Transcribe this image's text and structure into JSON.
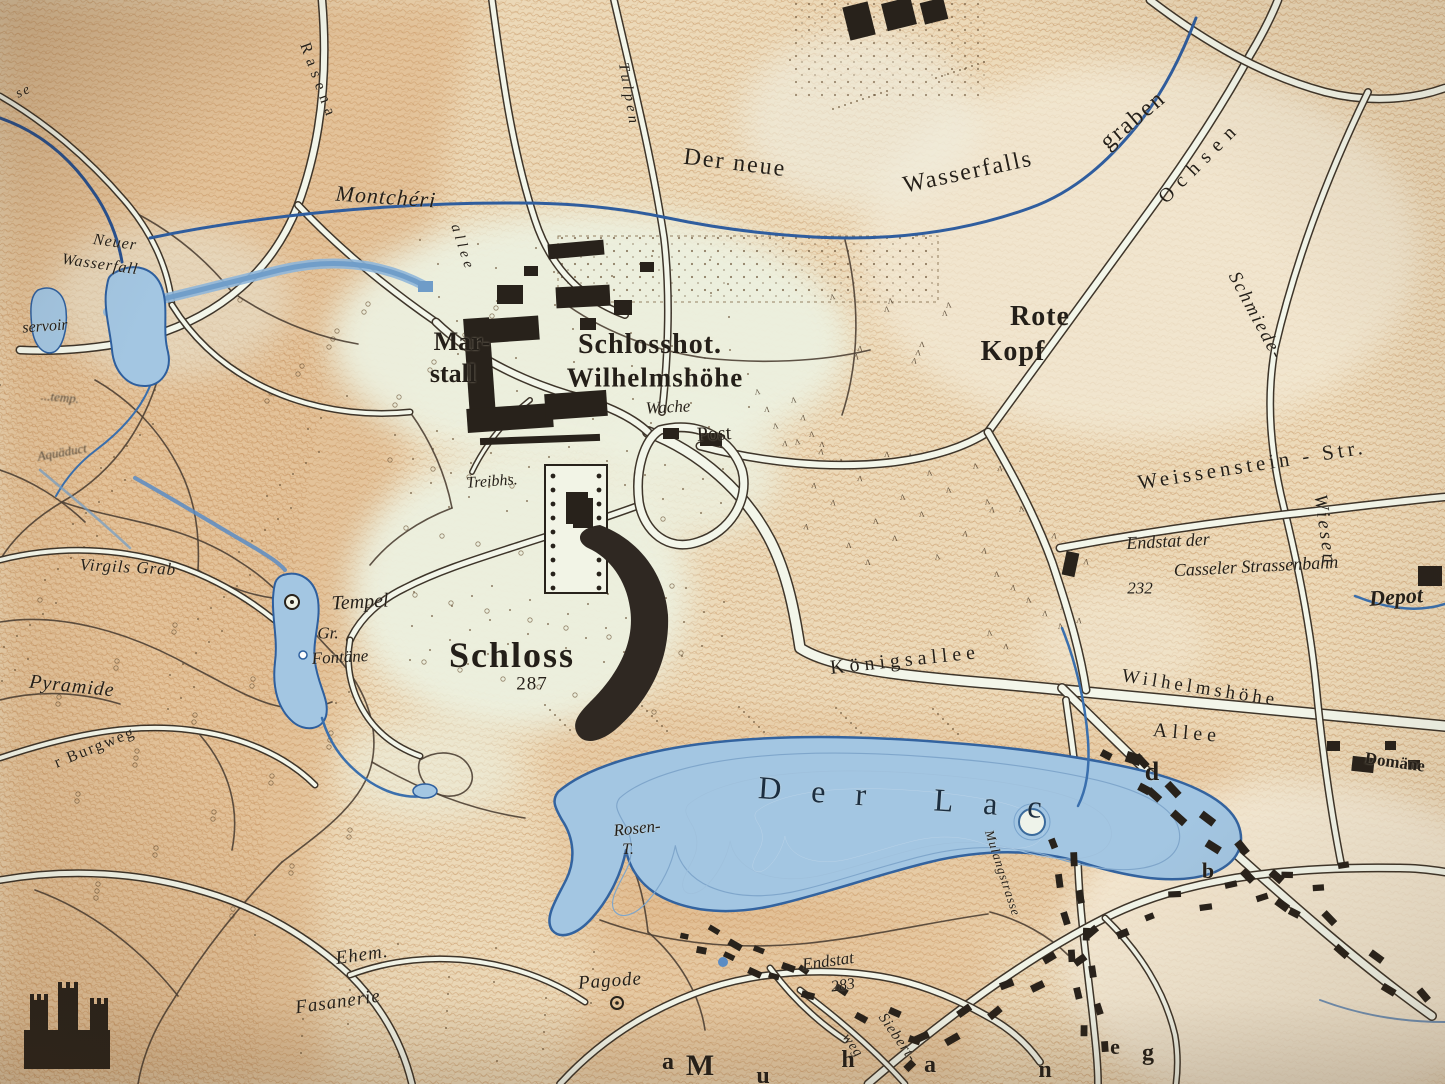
{
  "map": {
    "colors": {
      "paper": "#ecd9b8",
      "hatch": "#c08a55",
      "orange_tint": "#cf9055",
      "park_light": "#edf1e0",
      "road_fill": "#f3f6ea",
      "road_edge": "#3e352a",
      "path_brown": "#4e4034",
      "water_fill": "#a3c6e2",
      "water_edge": "#2e5f9e",
      "stream_blue": "#2f5d9e",
      "cascade_blue": "#6f9cc8",
      "building_ink": "#28221b",
      "label_ink": "#241f19",
      "lake_label_ink": "#1c2e40"
    },
    "labels": [
      {
        "name": "label-der-neue",
        "text": "Der neue",
        "x": 735,
        "y": 163,
        "s": 24,
        "r": 7,
        "ls": 2,
        "cls": ""
      },
      {
        "name": "label-wasserfalls",
        "text": "Wasserfalls",
        "x": 968,
        "y": 172,
        "s": 24,
        "r": -12,
        "ls": 2,
        "cls": ""
      },
      {
        "name": "label-graben",
        "text": "graben",
        "x": 1133,
        "y": 120,
        "s": 24,
        "r": -40,
        "ls": 2,
        "cls": ""
      },
      {
        "name": "label-rasenallee",
        "text": "Rasena",
        "x": 318,
        "y": 82,
        "s": 16,
        "r": 70,
        "ls": 6,
        "cls": ""
      },
      {
        "name": "label-montcheri",
        "text": "Montchéri",
        "x": 386,
        "y": 197,
        "s": 22,
        "r": 4,
        "ls": 1,
        "cls": "i"
      },
      {
        "name": "label-tulpenallee-1",
        "text": "Tulpen",
        "x": 628,
        "y": 95,
        "s": 15,
        "r": 80,
        "ls": 4,
        "cls": "i"
      },
      {
        "name": "label-tulpenallee-2",
        "text": "allee",
        "x": 462,
        "y": 248,
        "s": 15,
        "r": 72,
        "ls": 4,
        "cls": "i"
      },
      {
        "name": "label-ochsenallee",
        "text": "Ochsen",
        "x": 1200,
        "y": 162,
        "s": 20,
        "r": -45,
        "ls": 8,
        "cls": ""
      },
      {
        "name": "label-schmiede",
        "text": "Schmiede-",
        "x": 1256,
        "y": 316,
        "s": 19,
        "r": 62,
        "ls": 2,
        "cls": "i"
      },
      {
        "name": "label-wiesen",
        "text": "Wiesen",
        "x": 1325,
        "y": 530,
        "s": 19,
        "r": 82,
        "ls": 3,
        "cls": "i"
      },
      {
        "name": "label-weissenstein-str",
        "text": "Weissenstein - Str.",
        "x": 1252,
        "y": 465,
        "s": 21,
        "r": -9,
        "ls": 4,
        "cls": ""
      },
      {
        "name": "label-rote",
        "text": "Rote",
        "x": 1040,
        "y": 317,
        "s": 28,
        "r": 0,
        "ls": 1,
        "cls": "b"
      },
      {
        "name": "label-kopf",
        "text": "Kopf",
        "x": 1013,
        "y": 352,
        "s": 28,
        "r": 0,
        "ls": 1,
        "cls": "b"
      },
      {
        "name": "label-endstat-der",
        "text": "Endstat der",
        "x": 1168,
        "y": 541,
        "s": 18,
        "r": -3,
        "ls": 0,
        "cls": "i"
      },
      {
        "name": "label-casseler",
        "text": "Casseler Strassenbahn",
        "x": 1256,
        "y": 566,
        "s": 18,
        "r": -3,
        "ls": 0,
        "cls": "i"
      },
      {
        "name": "label-232",
        "text": "232",
        "x": 1140,
        "y": 588,
        "s": 17,
        "r": 0,
        "ls": 0,
        "cls": "i"
      },
      {
        "name": "label-depot",
        "text": "Depot",
        "x": 1396,
        "y": 597,
        "s": 22,
        "r": -4,
        "ls": 0,
        "cls": "i b"
      },
      {
        "name": "label-schlosshotel-1",
        "text": "Schlosshot.",
        "x": 650,
        "y": 345,
        "s": 28,
        "r": 0,
        "ls": 1,
        "cls": "b"
      },
      {
        "name": "label-schlosshotel-2",
        "text": "Wilhelmshöhe",
        "x": 655,
        "y": 378,
        "s": 27,
        "r": 0,
        "ls": 1,
        "cls": "b"
      },
      {
        "name": "label-marstall-1",
        "text": "Mar-",
        "x": 462,
        "y": 342,
        "s": 26,
        "r": 0,
        "ls": 0,
        "cls": "b"
      },
      {
        "name": "label-marstall-2",
        "text": "stall",
        "x": 453,
        "y": 374,
        "s": 26,
        "r": 0,
        "ls": 0,
        "cls": "b"
      },
      {
        "name": "label-wache",
        "text": "Wache",
        "x": 668,
        "y": 407,
        "s": 17,
        "r": -3,
        "ls": 0,
        "cls": "i"
      },
      {
        "name": "label-post",
        "text": "Post",
        "x": 714,
        "y": 434,
        "s": 20,
        "r": -3,
        "ls": 0,
        "cls": ""
      },
      {
        "name": "label-treibhs",
        "text": "Treibhs.",
        "x": 492,
        "y": 482,
        "s": 16,
        "r": -4,
        "ls": 0,
        "cls": "i"
      },
      {
        "name": "label-schloss",
        "text": "Schloss",
        "x": 512,
        "y": 655,
        "s": 36,
        "r": 0,
        "ls": 2,
        "cls": "b"
      },
      {
        "name": "label-287",
        "text": "287",
        "x": 532,
        "y": 684,
        "s": 19,
        "r": 0,
        "ls": 1,
        "cls": ""
      },
      {
        "name": "label-tempel",
        "text": "Tempel",
        "x": 360,
        "y": 602,
        "s": 20,
        "r": -3,
        "ls": 0,
        "cls": "i"
      },
      {
        "name": "label-gr",
        "text": "Gr.",
        "x": 328,
        "y": 633,
        "s": 17,
        "r": 0,
        "ls": 0,
        "cls": "i"
      },
      {
        "name": "label-fontaene",
        "text": "Fontäne",
        "x": 340,
        "y": 657,
        "s": 17,
        "r": -3,
        "ls": 0,
        "cls": "i"
      },
      {
        "name": "label-pyramide",
        "text": "Pyramide",
        "x": 72,
        "y": 686,
        "s": 20,
        "r": 6,
        "ls": 1,
        "cls": "i"
      },
      {
        "name": "label-virgils-grab",
        "text": "Virgils Grab",
        "x": 128,
        "y": 567,
        "s": 17,
        "r": 3,
        "ls": 1,
        "cls": "i"
      },
      {
        "name": "label-tempel-frag",
        "text": "...temp.",
        "x": 60,
        "y": 397,
        "s": 13,
        "r": 5,
        "ls": 0,
        "cls": "i faint"
      },
      {
        "name": "label-reservoir",
        "text": "servoir",
        "x": 45,
        "y": 327,
        "s": 16,
        "r": -4,
        "ls": 0,
        "cls": "i"
      },
      {
        "name": "label-neuer",
        "text": "Neuer",
        "x": 115,
        "y": 243,
        "s": 16,
        "r": 8,
        "ls": 1,
        "cls": "i"
      },
      {
        "name": "label-wasserfall",
        "text": "Wasserfall",
        "x": 100,
        "y": 265,
        "s": 16,
        "r": 8,
        "ls": 1,
        "cls": "i"
      },
      {
        "name": "label-aquaeduct",
        "text": "Aquäduct",
        "x": 62,
        "y": 452,
        "s": 13,
        "r": -10,
        "ls": 0,
        "cls": "i faint"
      },
      {
        "name": "label-koenigsallee",
        "text": "Königsallee",
        "x": 905,
        "y": 660,
        "s": 20,
        "r": -6,
        "ls": 5,
        "cls": ""
      },
      {
        "name": "label-wilhelmshoeher-allee-1",
        "text": "Wilhelmshöhe",
        "x": 1200,
        "y": 688,
        "s": 19,
        "r": 9,
        "ls": 4,
        "cls": ""
      },
      {
        "name": "label-wilhelmshoeher-allee-2",
        "text": "Allee",
        "x": 1187,
        "y": 733,
        "s": 20,
        "r": 5,
        "ls": 5,
        "cls": ""
      },
      {
        "name": "label-domaene",
        "text": "Domäne",
        "x": 1395,
        "y": 762,
        "s": 17,
        "r": 8,
        "ls": 0,
        "cls": "b"
      },
      {
        "name": "label-der-lac",
        "text": "Der Lac",
        "x": 915,
        "y": 798,
        "s": 32,
        "r": 4,
        "ls": 30,
        "cls": "lake"
      },
      {
        "name": "label-rosen",
        "text": "Rosen-",
        "x": 637,
        "y": 828,
        "s": 17,
        "r": -6,
        "ls": 0,
        "cls": "i"
      },
      {
        "name": "label-rosen-t",
        "text": "T.",
        "x": 628,
        "y": 850,
        "s": 16,
        "r": 0,
        "ls": 0,
        "cls": "i"
      },
      {
        "name": "label-mulangstrasse",
        "text": "Mulangstrasse",
        "x": 1003,
        "y": 873,
        "s": 13,
        "r": 72,
        "ls": 1,
        "cls": "i"
      },
      {
        "name": "label-ehem",
        "text": "Ehem.",
        "x": 362,
        "y": 955,
        "s": 19,
        "r": -8,
        "ls": 1,
        "cls": "i"
      },
      {
        "name": "label-fasanerie",
        "text": "Fasanerie",
        "x": 338,
        "y": 1002,
        "s": 19,
        "r": -8,
        "ls": 1,
        "cls": "i"
      },
      {
        "name": "label-pagode",
        "text": "Pagode",
        "x": 610,
        "y": 981,
        "s": 19,
        "r": -4,
        "ls": 1,
        "cls": "i"
      },
      {
        "name": "label-endstat-283-1",
        "text": "Endstat",
        "x": 828,
        "y": 961,
        "s": 17,
        "r": -8,
        "ls": 0,
        "cls": "i"
      },
      {
        "name": "label-endstat-283-2",
        "text": "283",
        "x": 843,
        "y": 986,
        "s": 16,
        "r": -8,
        "ls": 0,
        "cls": "i"
      },
      {
        "name": "label-siebertweg-1",
        "text": "Siebert-",
        "x": 897,
        "y": 1038,
        "s": 15,
        "r": 55,
        "ls": 1,
        "cls": "i"
      },
      {
        "name": "label-siebertweg-2",
        "text": "weg",
        "x": 852,
        "y": 1046,
        "s": 14,
        "r": 55,
        "ls": 1,
        "cls": "i"
      },
      {
        "name": "label-burgweg",
        "text": "r Burgweg",
        "x": 95,
        "y": 748,
        "s": 16,
        "r": -22,
        "ls": 2,
        "cls": ""
      },
      {
        "name": "label-se-frag",
        "text": "se",
        "x": 24,
        "y": 92,
        "s": 14,
        "r": -25,
        "ls": 2,
        "cls": "i"
      },
      {
        "name": "letter-a1",
        "text": "a",
        "x": 668,
        "y": 1062,
        "s": 24,
        "r": 0,
        "ls": 0,
        "cls": "big"
      },
      {
        "name": "letter-m",
        "text": "M",
        "x": 700,
        "y": 1066,
        "s": 30,
        "r": 0,
        "ls": 0,
        "cls": "big"
      },
      {
        "name": "letter-u",
        "text": "u",
        "x": 763,
        "y": 1076,
        "s": 24,
        "r": 0,
        "ls": 0,
        "cls": "big"
      },
      {
        "name": "letter-h",
        "text": "h",
        "x": 848,
        "y": 1060,
        "s": 24,
        "r": 0,
        "ls": 0,
        "cls": "big"
      },
      {
        "name": "letter-a2",
        "text": "a",
        "x": 930,
        "y": 1065,
        "s": 24,
        "r": 0,
        "ls": 0,
        "cls": "big"
      },
      {
        "name": "letter-n",
        "text": "n",
        "x": 1045,
        "y": 1070,
        "s": 24,
        "r": 0,
        "ls": 0,
        "cls": "big"
      },
      {
        "name": "letter-e",
        "text": "e",
        "x": 1115,
        "y": 1047,
        "s": 22,
        "r": 0,
        "ls": 0,
        "cls": "big"
      },
      {
        "name": "letter-g",
        "text": "g",
        "x": 1148,
        "y": 1053,
        "s": 24,
        "r": 0,
        "ls": 0,
        "cls": "big"
      },
      {
        "name": "letter-d",
        "text": "d",
        "x": 1152,
        "y": 772,
        "s": 26,
        "r": 0,
        "ls": 0,
        "cls": "big"
      },
      {
        "name": "letter-b",
        "text": "b",
        "x": 1208,
        "y": 871,
        "s": 22,
        "r": 0,
        "ls": 0,
        "cls": "big"
      }
    ],
    "symbols": [
      {
        "name": "loewenburg-castle-icon",
        "x": 26,
        "y": 985
      },
      {
        "name": "tempel-circle-icon",
        "x": 292,
        "y": 602
      },
      {
        "name": "fontaene-dot-icon",
        "x": 303,
        "y": 655
      },
      {
        "name": "pagode-circle-icon",
        "x": 617,
        "y": 1003
      },
      {
        "name": "lake-island-icon",
        "x": 1032,
        "y": 822
      },
      {
        "name": "tram-terminus-building",
        "x": 1070,
        "y": 562
      },
      {
        "name": "depot-building",
        "x": 1418,
        "y": 566
      }
    ]
  }
}
